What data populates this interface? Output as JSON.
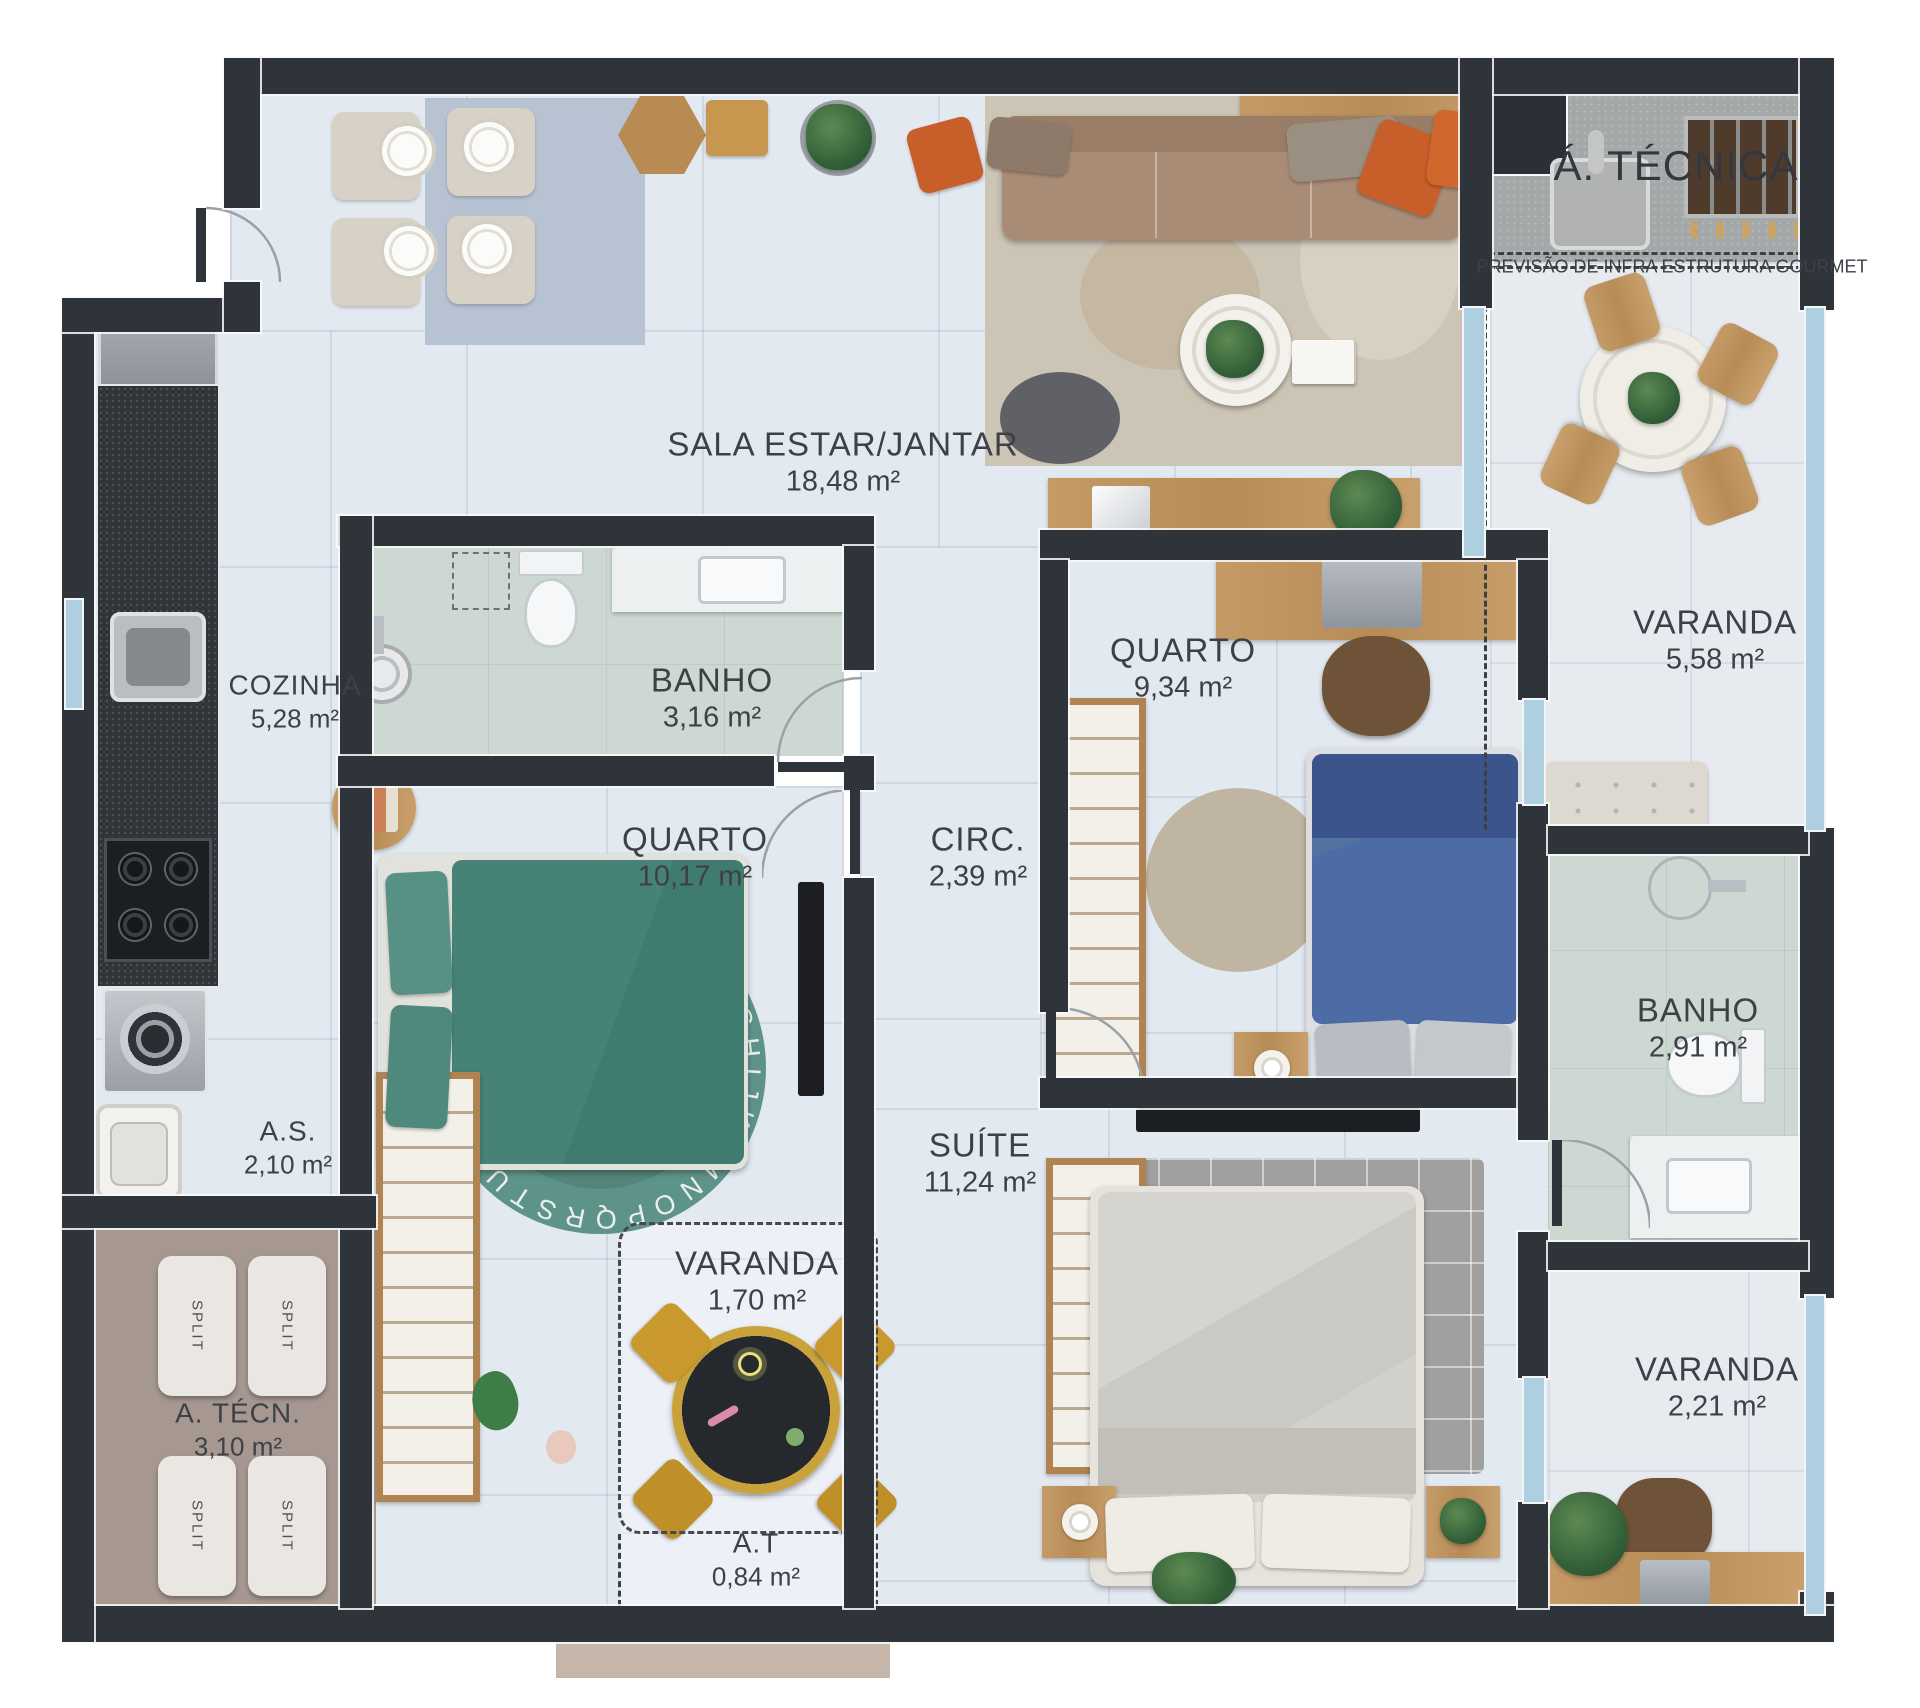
{
  "palette": {
    "wall": "#2f333a",
    "floor_main": "#e3e9f1",
    "floor_bath": "#cdd8d2",
    "floor_technical": "#a4a8a8",
    "floor_service": "#a69890",
    "wood": "#c49a66",
    "sofa": "#a98c75",
    "accent_orange": "#c85f2b",
    "bed_teal": "#3f7b6f",
    "bed_blue": "#4d6ba4",
    "rug_teal": "#5e938a",
    "balcony_glass": "#aecfdf"
  },
  "rooms": {
    "sala": {
      "name": "SALA ESTAR/JANTAR",
      "area": "18,48 m²"
    },
    "cozinha": {
      "name": "COZINHA",
      "area": "5,28 m²"
    },
    "banho1": {
      "name": "BANHO",
      "area": "3,16 m²"
    },
    "quarto1": {
      "name": "QUARTO",
      "area": "9,34 m²"
    },
    "varanda_gourmet": {
      "name": "VARANDA",
      "area": "5,58 m²"
    },
    "quarto2": {
      "name": "QUARTO",
      "area": "10,17 m²"
    },
    "circ": {
      "name": "CIRC.",
      "area": "2,39 m²"
    },
    "area_servico": {
      "name": "A.S.",
      "area": "2,10 m²"
    },
    "suite": {
      "name": "SUÍTE",
      "area": "11,24 m²"
    },
    "banho2": {
      "name": "BANHO",
      "area": "2,91 m²"
    },
    "varanda_kids": {
      "name": "VARANDA",
      "area": "1,70 m²"
    },
    "area_tecnica_inferior": {
      "name": "A. TÉCN.",
      "area": "3,10 m²"
    },
    "varanda_suite": {
      "name": "VARANDA",
      "area": "2,21 m²"
    },
    "at_pequena": {
      "name": "A.T",
      "area": "0,84 m²"
    },
    "area_tecnica_superior": {
      "name": "Á. TÉCNICA"
    }
  },
  "labels": {
    "previsao": "PREVISÃO DE INFRA ESTRUTURA GOURMET",
    "split": "SPLIT",
    "rug_letters": "ABCDEFGHIJKLMNOPQRSTUVWXYZ"
  }
}
